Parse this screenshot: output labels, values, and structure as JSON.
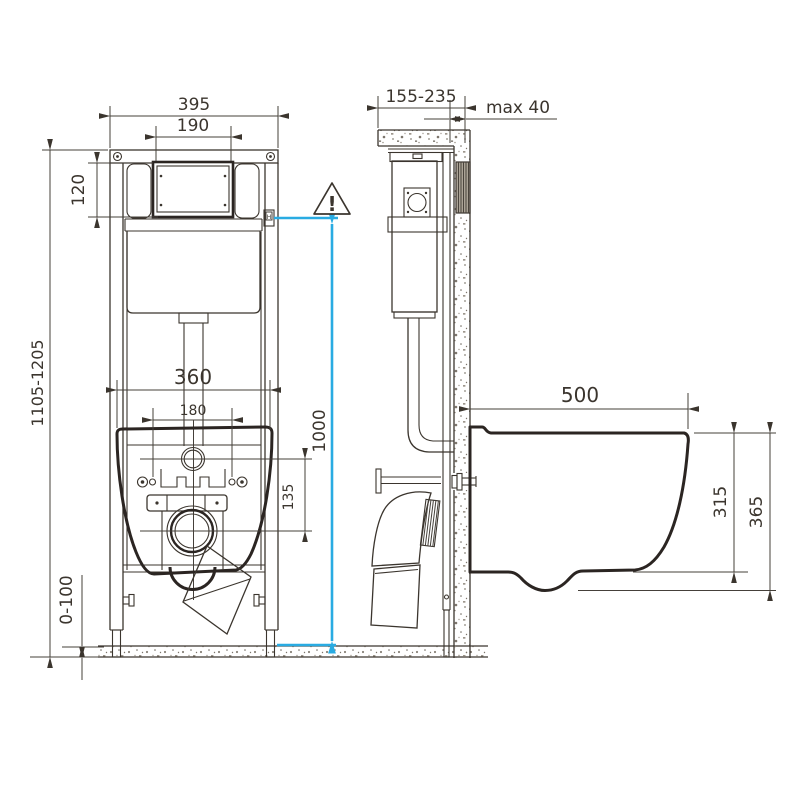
{
  "front_view": {
    "width_total": "395",
    "plate_width": "190",
    "plate_height": "120",
    "height_range": "1105-1205",
    "mount_width": "360",
    "hole_spacing": "180",
    "inlet_to_outlet": "135",
    "floor_adjust": "0-100",
    "plate_mark": "H"
  },
  "side_view": {
    "depth_range": "155-235",
    "wall_finish_max": "max 40"
  },
  "bowl": {
    "depth": "500",
    "height_rim": "315",
    "height_total": "365"
  },
  "annotation": {
    "flush_height": "1000",
    "warning_mark": "!"
  },
  "colors": {
    "highlight": "#29abe2",
    "line": "#3b352e"
  }
}
